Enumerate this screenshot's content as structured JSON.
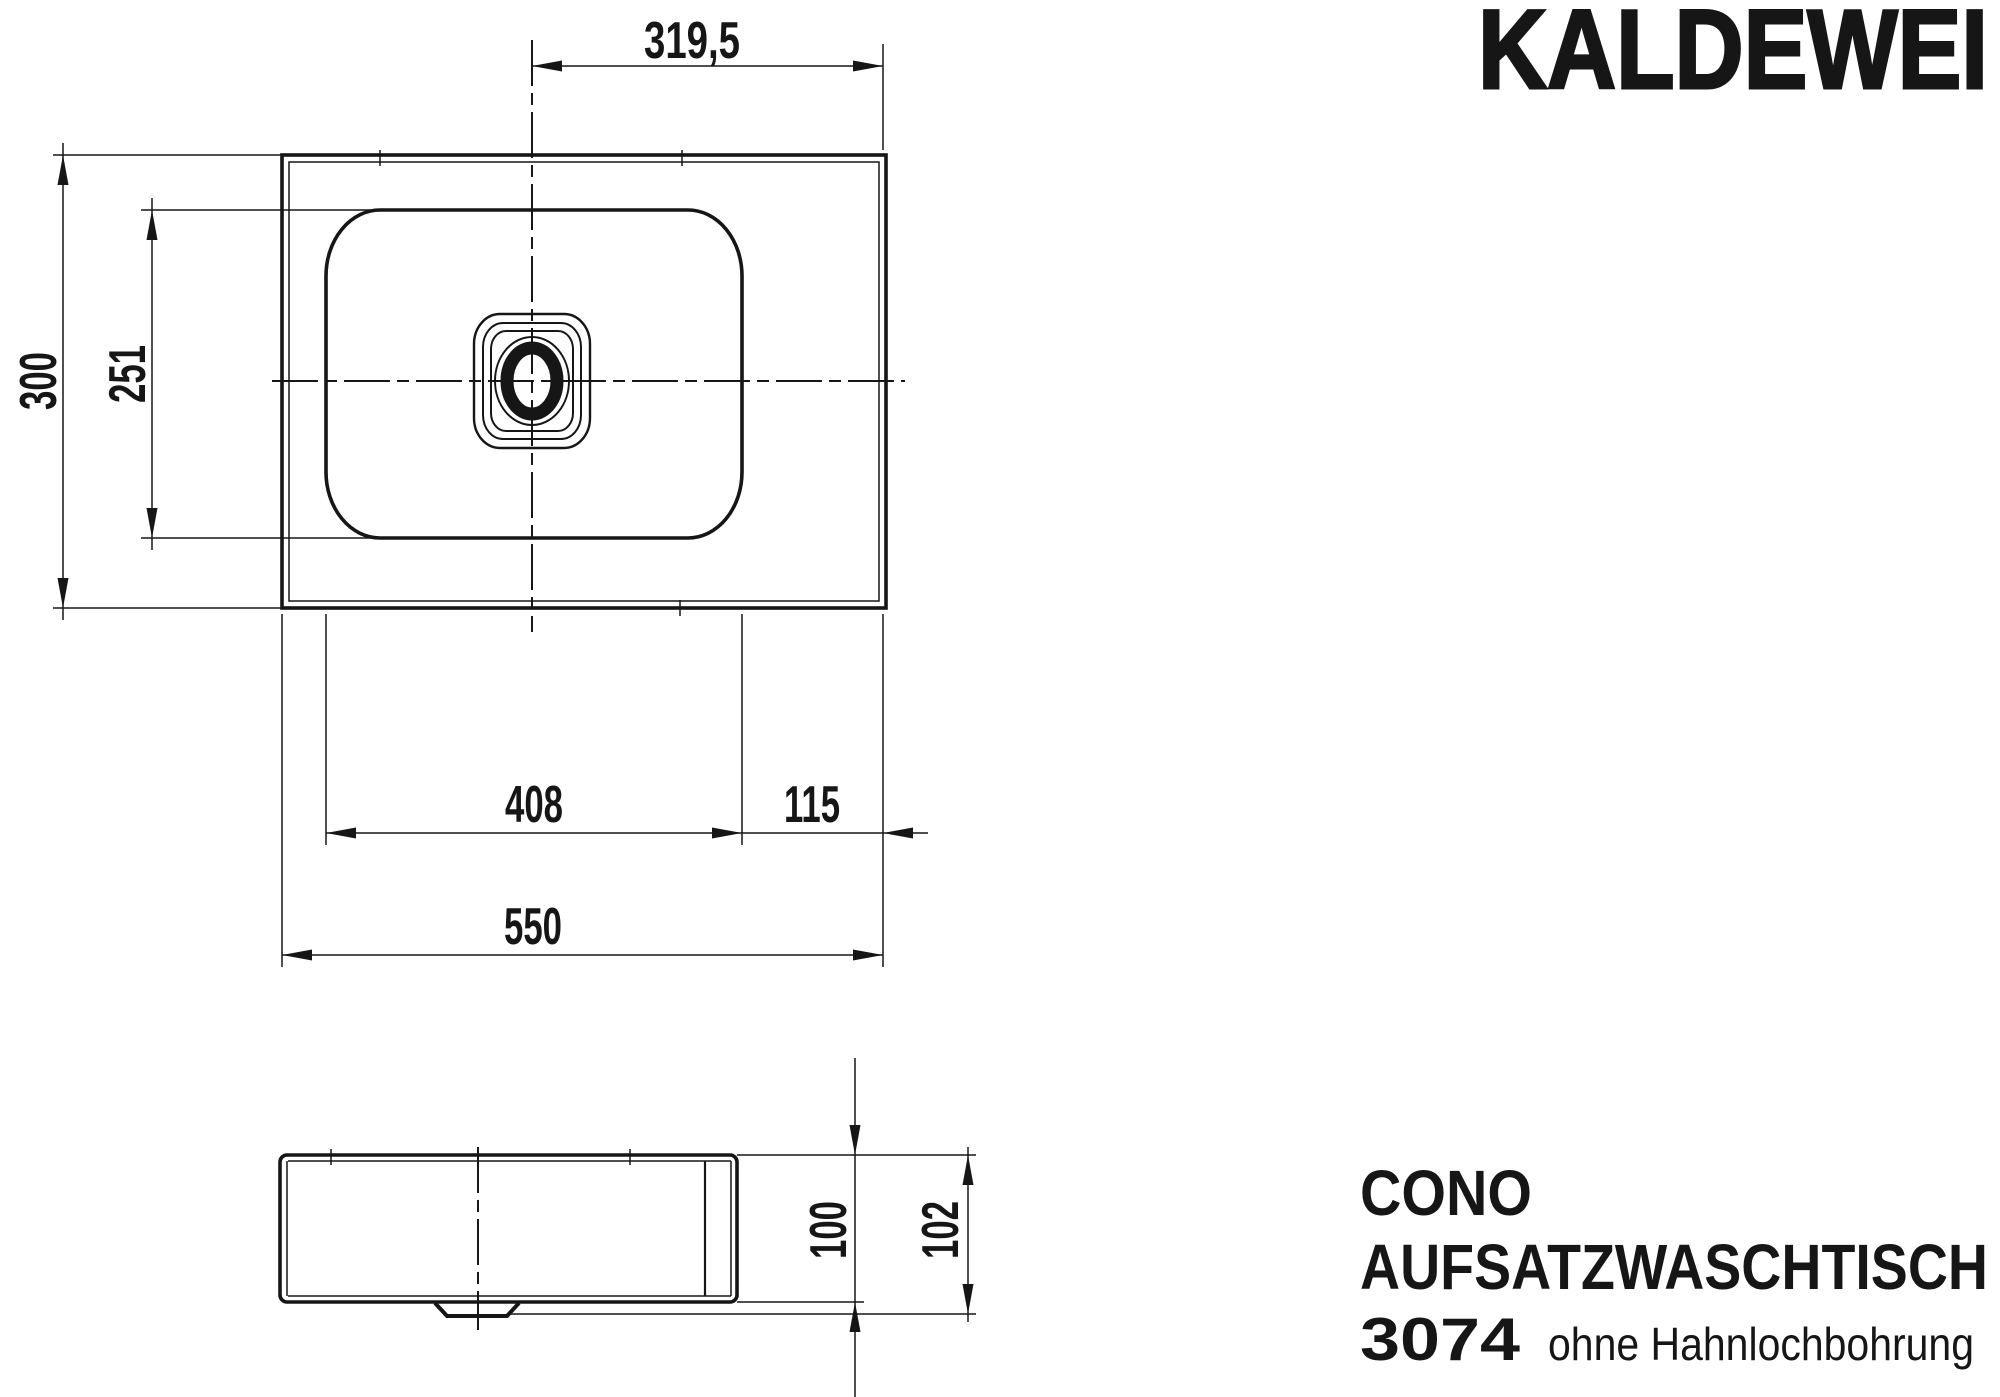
{
  "brand": {
    "logo": "KALDEWEI"
  },
  "product": {
    "series": "CONO",
    "type": "AUFSATZWASCHTISCH",
    "model": "3074",
    "variant": "ohne Hahnlochbohrung"
  },
  "views": {
    "plan": {
      "label": "top-view-of-washbasin",
      "dimensions": {
        "drain_offset_from_right": "319,5",
        "total_depth": "300",
        "basin_depth": "251",
        "basin_width": "408",
        "right_rim_width": "115",
        "total_width": "550"
      }
    },
    "side": {
      "label": "side-elevation-of-washbasin",
      "dimensions": {
        "body_height": "100",
        "total_height": "102"
      }
    }
  }
}
